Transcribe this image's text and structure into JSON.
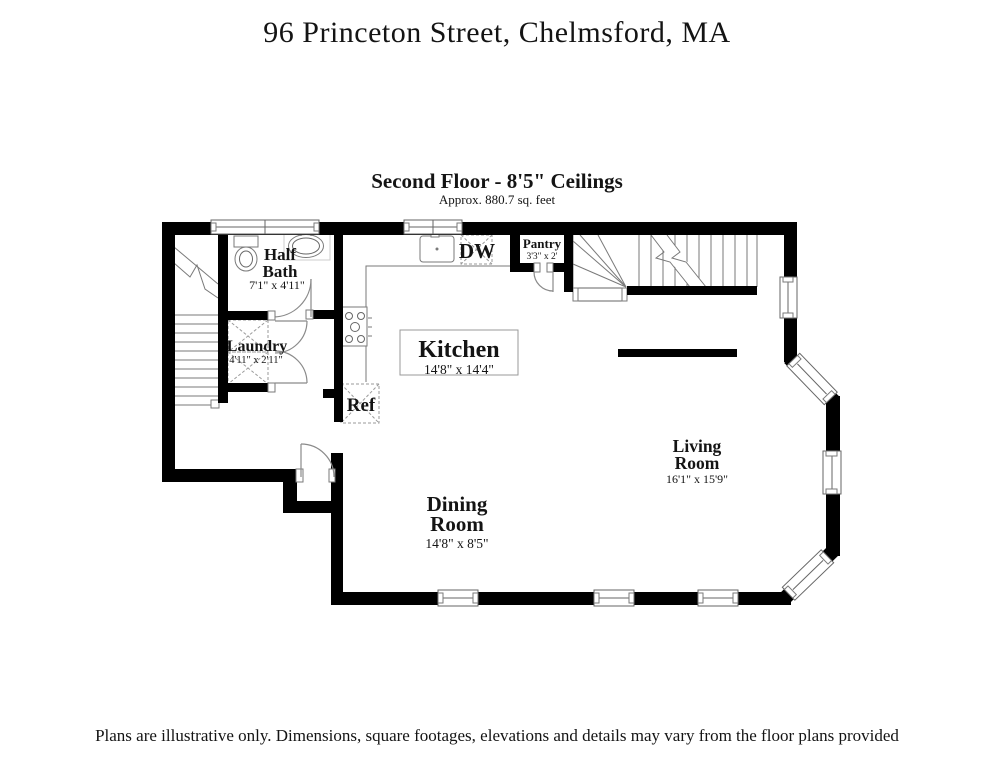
{
  "header": {
    "title": "96 Princeton Street, Chelmsford, MA"
  },
  "plan": {
    "heading": "Second Floor - 8'5\" Ceilings",
    "subheading": "Approx. 880.7 sq. feet",
    "rooms": {
      "half_bath": {
        "line1": "Half",
        "line2": "Bath",
        "dims": "7'1\" x 4'11\""
      },
      "laundry": {
        "name": "Laundry",
        "dims": "4'11\" x 2'11\""
      },
      "kitchen": {
        "name": "Kitchen",
        "dims": "14'8\" x 14'4\""
      },
      "pantry": {
        "name": "Pantry",
        "dims": "3'3\" x 2'"
      },
      "dining_room": {
        "line1": "Dining",
        "line2": "Room",
        "dims": "14'8\" x 8'5\""
      },
      "living_room": {
        "line1": "Living",
        "line2": "Room",
        "dims": "16'1\" x 15'9\""
      }
    },
    "appliances": {
      "dishwasher": "DW",
      "refrigerator": "Ref"
    }
  },
  "footer": {
    "disclaimer": "Plans are illustrative only. Dimensions, square footages, elevations and details may vary from the floor plans provided"
  }
}
